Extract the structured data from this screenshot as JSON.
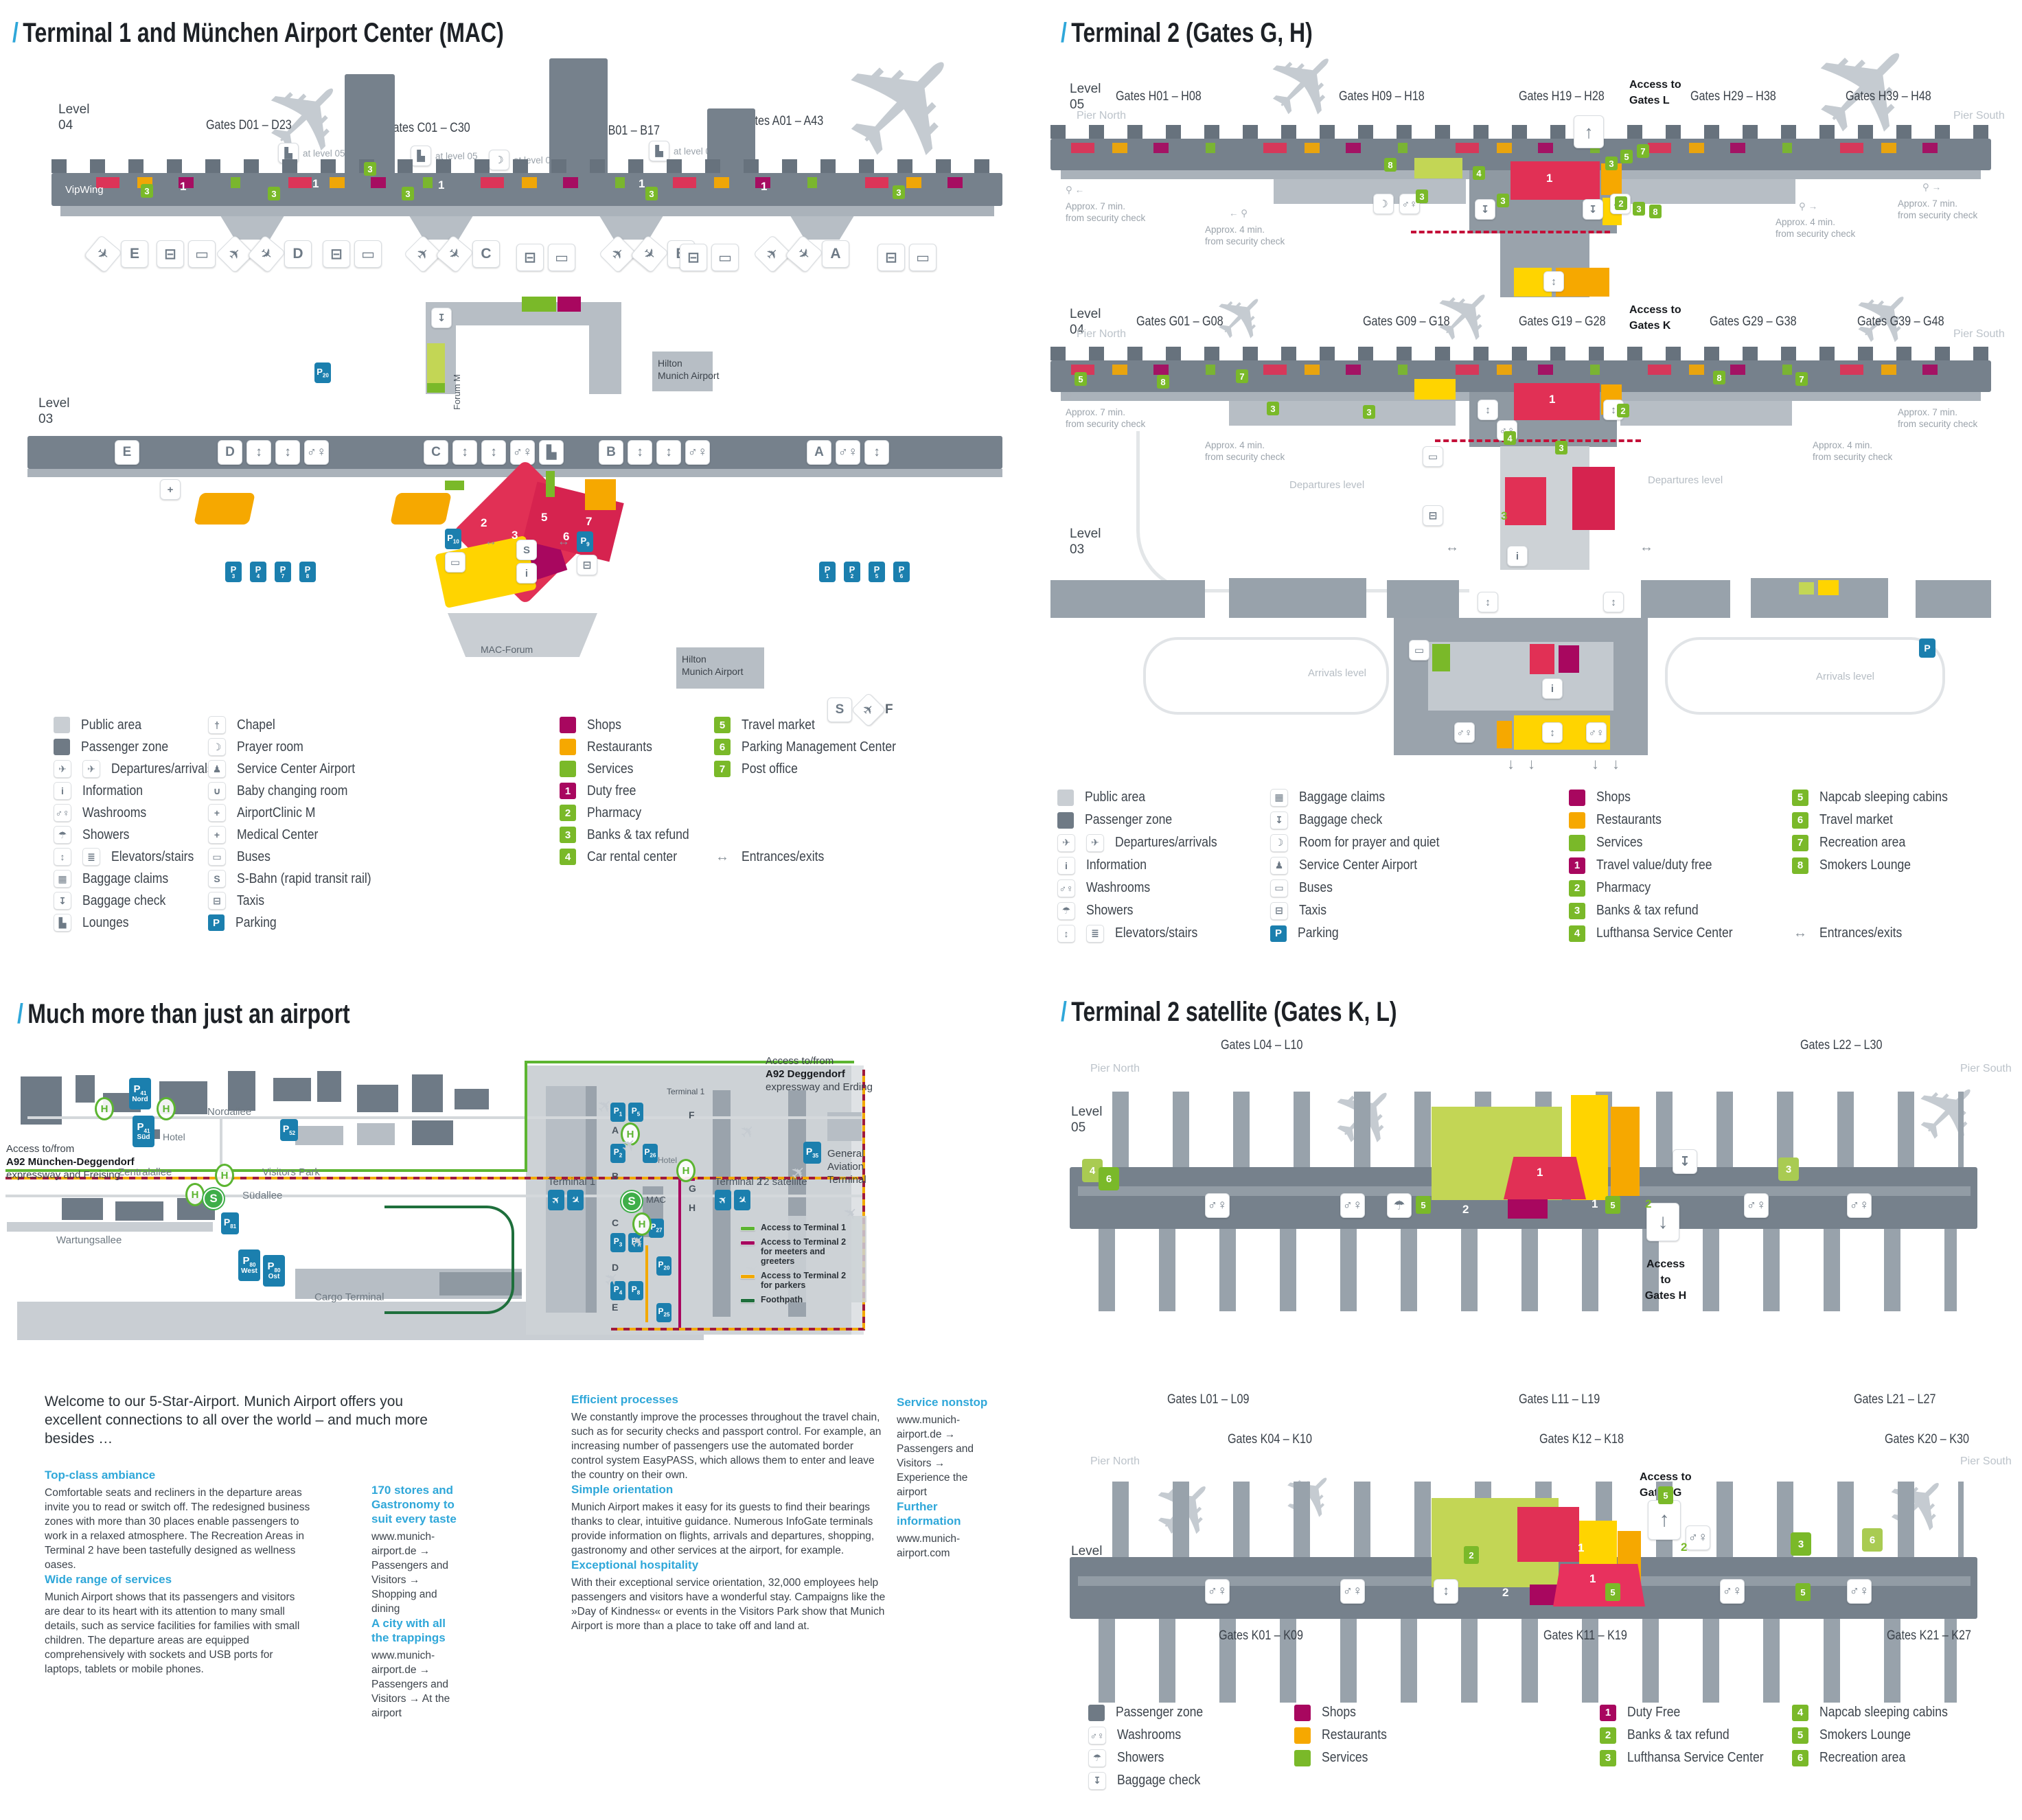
{
  "icons": {
    "plane": "✈",
    "dep": "✈",
    "arr": "✈",
    "taxi": "⊟",
    "bus": "▭",
    "sbahn": "S",
    "info": "i",
    "wash": "♂♀",
    "elev": "↕",
    "lounge": "▙",
    "prayer": "☽",
    "shower": "☂",
    "medical": "+",
    "bag": "▦",
    "bagcheck": "↧",
    "walker": "⚲",
    "lr": "↔",
    "up": "↑",
    "down": "↓",
    "chapel": "†"
  },
  "colors": {
    "accent": "#2fa7d9",
    "shops": "#a8075f",
    "restaurants": "#f6a800",
    "services": "#7ab929",
    "yellow": "#ffd400",
    "red": "#e13055",
    "parking": "#1b7fae",
    "public": "#c9ced3",
    "zone": "#6f7a85",
    "green_route": "#5cb531",
    "meeters": "#a8075f",
    "parkers": "#f2a900",
    "foothpath": "#1e6f3c",
    "dashed_red": "#c41039"
  },
  "t1": {
    "title": "Terminal 1 and München Airport Center (MAC)",
    "l04": {
      "level": "Level",
      "num": "04",
      "vipwing": "VipWing",
      "at05": "at level 05",
      "gates": [
        "Gates D01 – D23",
        "Gates C01 – C30",
        "Gates B01 – B17",
        "Gates A01 – A43"
      ],
      "areas": [
        "E",
        "D",
        "C",
        "B",
        "A"
      ],
      "badges_green": [
        "3",
        "3",
        "3",
        "3",
        "3",
        "3"
      ],
      "badges_white": [
        "1",
        "1",
        "1",
        "1",
        "1"
      ]
    },
    "mid": {
      "p20": "20",
      "forum": "Forum M",
      "hilton": [
        "Hilton",
        "Munich Airport"
      ]
    },
    "l03": {
      "level": "Level",
      "num": "03",
      "sections": [
        "E",
        "D",
        "C",
        "B",
        "A"
      ],
      "p_left": [
        "3",
        "4",
        "7",
        "8"
      ],
      "p_right": [
        "1",
        "2",
        "5",
        "6"
      ],
      "p10": "10",
      "p9": "9",
      "mac_badges": [
        "2",
        "3",
        "5",
        "6",
        "7"
      ],
      "mac_forum": "MAC-Forum",
      "hilton": [
        "Hilton",
        "Munich Airport"
      ],
      "f": "F"
    },
    "legend": {
      "col1": [
        {
          "t": "sw",
          "c": "#c9ced3",
          "label": "Public area"
        },
        {
          "t": "sw",
          "c": "#6f7a85",
          "label": "Passenger zone"
        },
        {
          "t": "ic",
          "k": "✈",
          "k2": "✈",
          "label": "Departures/arrivals"
        },
        {
          "t": "ic",
          "k": "i",
          "label": "Information"
        },
        {
          "t": "ic",
          "k": "♂♀",
          "label": "Washrooms"
        },
        {
          "t": "ic",
          "k": "☂",
          "label": "Showers"
        },
        {
          "t": "ic",
          "k": "↕",
          "k2": "≣",
          "label": "Elevators/stairs"
        },
        {
          "t": "ic",
          "k": "▦",
          "label": "Baggage claims"
        },
        {
          "t": "ic",
          "k": "↧",
          "label": "Baggage check"
        },
        {
          "t": "ic",
          "k": "▙",
          "label": "Lounges"
        }
      ],
      "col2": [
        {
          "t": "ic",
          "k": "†",
          "label": "Chapel"
        },
        {
          "t": "ic",
          "k": "☽",
          "label": "Prayer room"
        },
        {
          "t": "ic",
          "k": "♟",
          "label": "Service Center Airport"
        },
        {
          "t": "ic",
          "k": "∪",
          "label": "Baby changing room"
        },
        {
          "t": "ic",
          "k": "+",
          "label": "AirportClinic M"
        },
        {
          "t": "ic",
          "k": "+",
          "label": "Medical Center"
        },
        {
          "t": "ic",
          "k": "▭",
          "label": "Buses"
        },
        {
          "t": "ic",
          "k": "S",
          "label": "S-Bahn (rapid transit rail)"
        },
        {
          "t": "ic",
          "k": "⊟",
          "label": "Taxis"
        },
        {
          "t": "p",
          "c": "#1b7fae",
          "k": "P",
          "label": "Parking"
        }
      ],
      "col3": [
        {
          "t": "sw",
          "c": "#a8075f",
          "label": "Shops"
        },
        {
          "t": "sw",
          "c": "#f6a800",
          "label": "Restaurants"
        },
        {
          "t": "sw",
          "c": "#7ab929",
          "label": "Services"
        },
        {
          "t": "num",
          "c": "#a8075f",
          "k": "1",
          "label": "Duty free"
        },
        {
          "t": "num",
          "c": "#7ab929",
          "k": "2",
          "label": "Pharmacy"
        },
        {
          "t": "num",
          "c": "#7ab929",
          "k": "3",
          "label": "Banks & tax refund"
        },
        {
          "t": "num",
          "c": "#7ab929",
          "k": "4",
          "label": "Car rental center"
        }
      ],
      "col4": [
        {
          "t": "num",
          "c": "#7ab929",
          "k": "5",
          "label": "Travel market"
        },
        {
          "t": "num",
          "c": "#7ab929",
          "k": "6",
          "label": "Parking Management Center"
        },
        {
          "t": "num",
          "c": "#7ab929",
          "k": "7",
          "label": "Post office"
        }
      ],
      "entrances": {
        "k": "↔",
        "label": "Entrances/exits"
      }
    }
  },
  "t2": {
    "title": "Terminal 2 (Gates G, H)",
    "l05": {
      "level": "Level",
      "num": "05",
      "pier_n": "Pier North",
      "pier_s": "Pier South",
      "gates": [
        "Gates H01 – H08",
        "Gates H09 – H18",
        "Gates H19 – H28",
        "Gates H29 – H38",
        "Gates H39 – H48"
      ],
      "access": [
        "Access to",
        "Gates L"
      ],
      "note7": [
        "Approx. 7 min.",
        "from security check"
      ],
      "note4": [
        "Approx. 4 min.",
        "from security check"
      ],
      "badges": [
        "8",
        "3",
        "4",
        "3",
        "3",
        "5",
        "7",
        "2",
        "3",
        "8"
      ],
      "big1": "1"
    },
    "l04": {
      "level": "Level",
      "num": "04",
      "pier_n": "Pier North",
      "pier_s": "Pier South",
      "gates": [
        "Gates G01 – G08",
        "Gates G09 – G18",
        "Gates G19 – G28",
        "Gates G29 – G38",
        "Gates G39 – G48"
      ],
      "access": [
        "Access to",
        "Gates K"
      ],
      "dep_level": "Departures level",
      "badges": [
        "5",
        "8",
        "7",
        "3",
        "3",
        "2",
        "4",
        "3",
        "8",
        "7"
      ],
      "big1": "1",
      "s3": "3"
    },
    "l03": {
      "level": "Level",
      "num": "03",
      "arr_level": "Arrivals level",
      "p": "P"
    },
    "legend": {
      "col1": [
        {
          "t": "sw",
          "c": "#c9ced3",
          "label": "Public area"
        },
        {
          "t": "sw",
          "c": "#6f7a85",
          "label": "Passenger zone"
        },
        {
          "t": "ic",
          "k": "✈",
          "k2": "✈",
          "label": "Departures/arrivals"
        },
        {
          "t": "ic",
          "k": "i",
          "label": "Information"
        },
        {
          "t": "ic",
          "k": "♂♀",
          "label": "Washrooms"
        },
        {
          "t": "ic",
          "k": "☂",
          "label": "Showers"
        },
        {
          "t": "ic",
          "k": "↕",
          "k2": "≣",
          "label": "Elevators/stairs"
        }
      ],
      "col2": [
        {
          "t": "ic",
          "k": "▦",
          "label": "Baggage claims"
        },
        {
          "t": "ic",
          "k": "↧",
          "label": "Baggage check"
        },
        {
          "t": "ic",
          "k": "☽",
          "label": "Room for prayer and quiet"
        },
        {
          "t": "ic",
          "k": "♟",
          "label": "Service Center Airport"
        },
        {
          "t": "ic",
          "k": "▭",
          "label": "Buses"
        },
        {
          "t": "ic",
          "k": "⊟",
          "label": "Taxis"
        },
        {
          "t": "p",
          "c": "#1b7fae",
          "k": "P",
          "label": "Parking"
        }
      ],
      "col3": [
        {
          "t": "sw",
          "c": "#a8075f",
          "label": "Shops"
        },
        {
          "t": "sw",
          "c": "#f6a800",
          "label": "Restaurants"
        },
        {
          "t": "sw",
          "c": "#7ab929",
          "label": "Services"
        },
        {
          "t": "num",
          "c": "#a8075f",
          "k": "1",
          "label": "Travel value/duty free"
        },
        {
          "t": "num",
          "c": "#7ab929",
          "k": "2",
          "label": "Pharmacy"
        },
        {
          "t": "num",
          "c": "#7ab929",
          "k": "3",
          "label": "Banks & tax refund"
        },
        {
          "t": "num",
          "c": "#7ab929",
          "k": "4",
          "label": "Lufthansa Service Center"
        }
      ],
      "col4": [
        {
          "t": "num",
          "c": "#7ab929",
          "k": "5",
          "label": "Napcab sleeping cabins"
        },
        {
          "t": "num",
          "c": "#7ab929",
          "k": "6",
          "label": "Travel market"
        },
        {
          "t": "num",
          "c": "#7ab929",
          "k": "7",
          "label": "Recreation area"
        },
        {
          "t": "num",
          "c": "#7ab929",
          "k": "8",
          "label": "Smokers Lounge"
        }
      ],
      "entrances": {
        "k": "↔",
        "label": "Entrances/exits"
      }
    }
  },
  "overview": {
    "title": "Much more than just an airport",
    "access_left": [
      "Access to/from",
      "A92 München-Deggendorf",
      "expressway and Freising"
    ],
    "access_right": [
      "Access to/from",
      "A92 Deggendorf",
      "expressway and Erding"
    ],
    "streets": {
      "nord": "Nordallee",
      "zentral": "Zentralallee",
      "sued": "Südallee",
      "wartung": "Wartungsallee"
    },
    "labels": {
      "visitors": "Visitors Park",
      "cargo": "Cargo Terminal",
      "hotel": "Hotel",
      "gat": [
        "General",
        "Aviation",
        "Terminal"
      ],
      "t1": "Terminal 1",
      "t1s": "Terminal 1",
      "mac": "MAC",
      "t2": "Terminal 2",
      "t2s": "T2 satellite"
    },
    "letters": [
      "A",
      "B",
      "C",
      "D",
      "E"
    ],
    "letters_r": [
      "F",
      "G",
      "H"
    ],
    "h": "H",
    "s": "S",
    "parking": {
      "p41n": {
        "n": "41",
        "s": "Nord"
      },
      "p41s": {
        "n": "41",
        "s": "Süd"
      },
      "p52": {
        "n": "52"
      },
      "p81": {
        "n": "81"
      },
      "p80w": {
        "n": "80",
        "s": "West"
      },
      "p80o": {
        "n": "80",
        "s": "Ost"
      },
      "p1": {
        "n": "1"
      },
      "p5": {
        "n": "5"
      },
      "p2": {
        "n": "2"
      },
      "p26": {
        "n": "26"
      },
      "p3": {
        "n": "3"
      },
      "p7": {
        "n": "7"
      },
      "p20": {
        "n": "20"
      },
      "p4": {
        "n": "4"
      },
      "p8": {
        "n": "8"
      },
      "p25": {
        "n": "25"
      },
      "p27": {
        "n": "27"
      },
      "p35": {
        "n": "35"
      }
    },
    "legend": [
      {
        "c": "#5cb531",
        "label": "Access to Terminal 1"
      },
      {
        "c": "#a8075f",
        "label": "Access to Terminal 2 for meeters and greeters"
      },
      {
        "c": "#f2a900",
        "label": "Access to Terminal 2 for parkers"
      },
      {
        "c": "#1e6f3c",
        "label": "Foothpath"
      }
    ],
    "welcome": "Welcome to our 5-Star-Airport. Munich Airport offers you excellent connections to all over the world – and much more besides …",
    "col1": [
      {
        "h": "Top-class ambiance",
        "p": "Comfortable seats and recliners in the departure areas invite you to read or switch off. The redesigned business zones with more than 30 places enable passengers to work in a relaxed atmosphere. The Recreation Areas in Terminal 2 have been tastefully designed as wellness oases."
      },
      {
        "h": "Wide range of services",
        "p": "Munich Airport shows that its passengers and visitors are dear to its heart with its attention to many small details, such as service facilities for families with small children. The departure areas are equipped comprehensively with sockets and USB ports for laptops, tablets or mobile phones."
      }
    ],
    "col2": [
      {
        "h": "170 stores and Gastronomy to suit every taste",
        "p": "www.munich-airport.de → Passengers and Visitors → Shopping and dining"
      },
      {
        "h": "A city with all the trappings",
        "p": "www.munich-airport.de → Passengers and Visitors → At the airport"
      }
    ],
    "col3": [
      {
        "h": "Efficient processes",
        "p": "We constantly improve the processes throughout the travel chain, such as for security checks and passport control. For example, an increasing number of passengers use the automated border control system EasyPASS, which allows them to enter and leave the country on their own."
      },
      {
        "h": "Simple orientation",
        "p": "Munich Airport makes it easy for its guests to find their bearings thanks to clear, intuitive guidance. Numerous InfoGate terminals provide information on flights, arrivals and departures, shopping, gastronomy and other services at the airport, for example."
      },
      {
        "h": "Exceptional hospitality",
        "p": "With their exceptional service orientation, 32,000 employees help passengers and visitors have a wonderful stay. Campaigns like the »Day of Kindness« or events in the Visitors Park show that Munich Airport is more than a place to take off and land at."
      }
    ],
    "col4": [
      {
        "h": "Service nonstop",
        "p": "www.munich-airport.de → Passengers and Visitors → Experience the airport"
      },
      {
        "h": "Further information",
        "p": "www.munich-airport.com"
      }
    ]
  },
  "sat": {
    "title": "Terminal 2 satellite (Gates K, L)",
    "l05": {
      "level": "Level",
      "num": "05",
      "pier_n": "Pier North",
      "pier_s": "Pier South",
      "gates_top": [
        "Gates L04 – L10",
        "Gates L22 – L30"
      ],
      "gates_bottom": [
        "Gates L01 – L09",
        "Gates L11 – L19",
        "Gates L21 – L27"
      ],
      "access": [
        "Access",
        "to",
        "Gates H"
      ],
      "g": [
        "4",
        "6",
        "5",
        "3",
        "5"
      ],
      "w": [
        "2",
        "1",
        "2"
      ],
      "big1": "1"
    },
    "l04": {
      "level": "Level",
      "num": "04",
      "pier_n": "Pier North",
      "pier_s": "Pier South",
      "gates_top": [
        "Gates K04 – K10",
        "Gates K12 – K18",
        "Gates K20 – K30"
      ],
      "gates_bottom": [
        "Gates K01 – K09",
        "Gates K11 – K19",
        "Gates K21 – K27"
      ],
      "access": [
        "Access to",
        "Gates G"
      ],
      "g": [
        "5",
        "2",
        "3",
        "6",
        "5",
        "5"
      ],
      "w": [
        "2",
        "1",
        "2"
      ],
      "big1": "1"
    },
    "legend": {
      "col1": [
        {
          "t": "sw",
          "c": "#6f7a85",
          "label": "Passenger zone"
        },
        {
          "t": "ic",
          "k": "♂♀",
          "label": "Washrooms"
        },
        {
          "t": "ic",
          "k": "☂",
          "label": "Showers"
        },
        {
          "t": "ic",
          "k": "↧",
          "label": "Baggage check"
        }
      ],
      "col2": [
        {
          "t": "sw",
          "c": "#a8075f",
          "label": "Shops"
        },
        {
          "t": "sw",
          "c": "#f6a800",
          "label": "Restaurants"
        },
        {
          "t": "sw",
          "c": "#7ab929",
          "label": "Services"
        }
      ],
      "col3": [
        {
          "t": "num",
          "c": "#a8075f",
          "k": "1",
          "label": "Duty Free"
        },
        {
          "t": "num",
          "c": "#7ab929",
          "k": "2",
          "label": "Banks & tax refund"
        },
        {
          "t": "num",
          "c": "#7ab929",
          "k": "3",
          "label": "Lufthansa Service Center"
        }
      ],
      "col4": [
        {
          "t": "num",
          "c": "#7ab929",
          "k": "4",
          "label": "Napcab sleeping cabins"
        },
        {
          "t": "num",
          "c": "#7ab929",
          "k": "5",
          "label": "Smokers Lounge"
        },
        {
          "t": "num",
          "c": "#7ab929",
          "k": "6",
          "label": "Recreation area"
        }
      ]
    }
  }
}
